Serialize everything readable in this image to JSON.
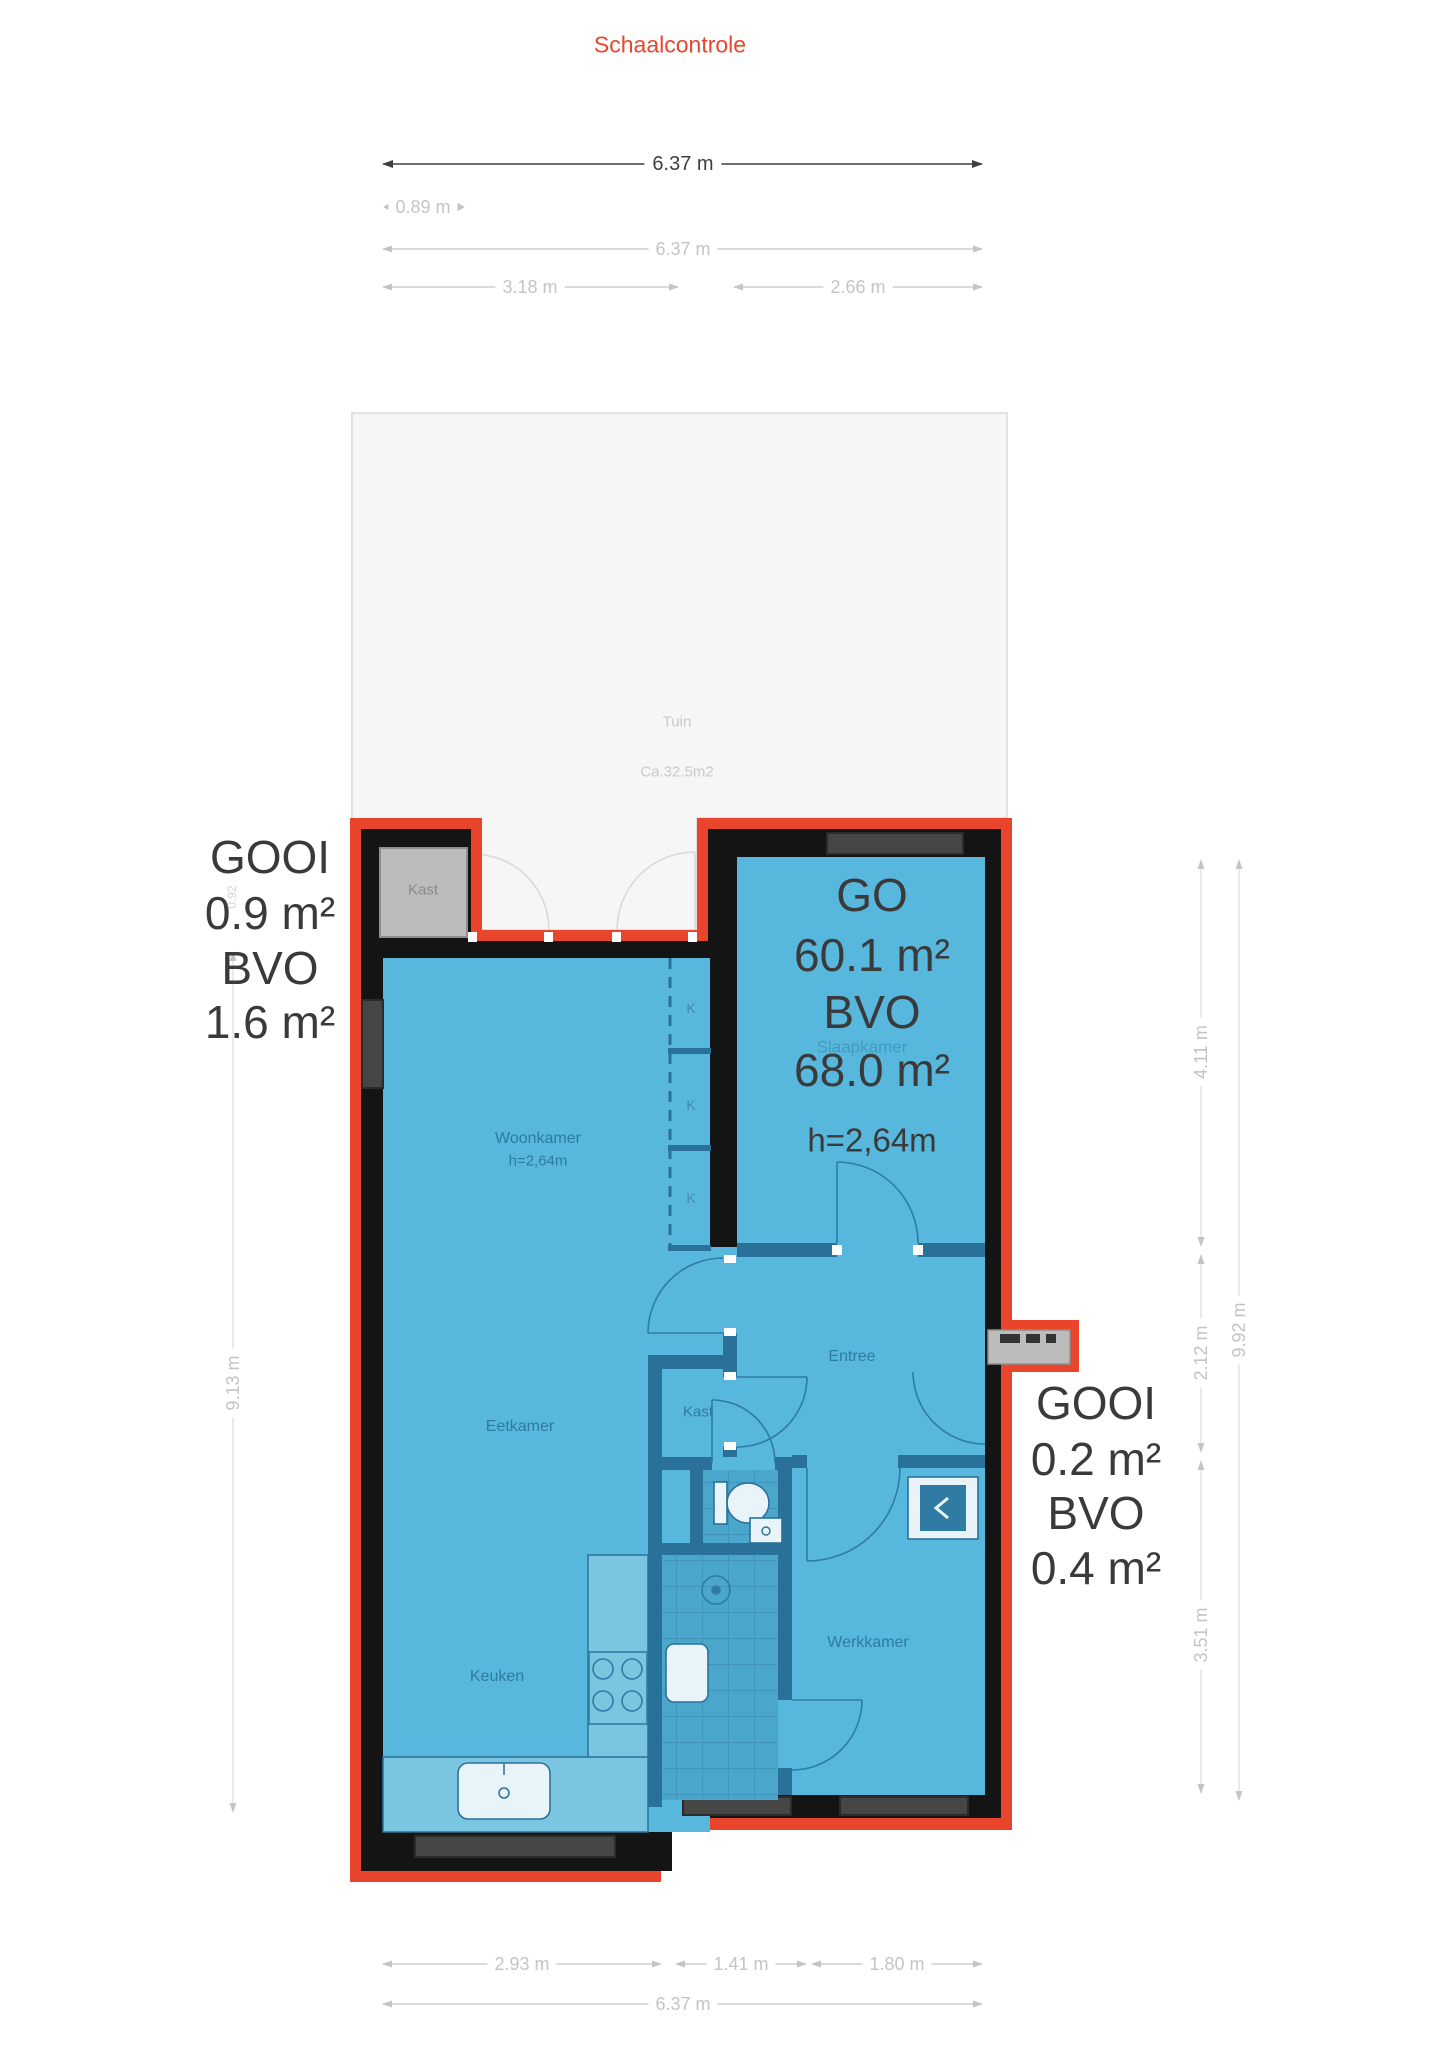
{
  "title": "Schaalcontrole",
  "garden": {
    "name": "Tuin",
    "area": "Ca.32.5m2"
  },
  "dims": {
    "top_main": "6.37 m",
    "top_offset": "0.89 m",
    "top_full": "6.37 m",
    "top_left": "3.18 m",
    "top_right": "2.66 m",
    "left_height": "9.13 m",
    "bump_height": "0.92",
    "right_seg1": "4.11 m",
    "right_seg2": "2.12 m",
    "right_seg3": "3.51 m",
    "right_full": "9.92 m",
    "bottom_left": "2.93 m",
    "bottom_mid": "1.41 m",
    "bottom_right": "1.80 m",
    "bottom_full": "6.37 m"
  },
  "area_left": {
    "line1": "GOOI",
    "line2": "0.9 m²",
    "line3": "BVO",
    "line4": "1.6 m²"
  },
  "area_right": {
    "line1": "GOOI",
    "line2": "0.2 m²",
    "line3": "BVO",
    "line4": "0.4 m²"
  },
  "area_main": {
    "line1": "GO",
    "line2": "60.1 m²",
    "line3": "BVO",
    "line4": "68.0 m²",
    "line5": "h=2,64m"
  },
  "rooms": {
    "woonkamer": "Woonkamer",
    "woonkamer_height": "h=2,64m",
    "slaapkamer": "Slaapkamer",
    "eetkamer": "Eetkamer",
    "keuken": "Keuken",
    "entree": "Entree",
    "werkkamer": "Werkkamer",
    "kast_bump": "Kast",
    "kast_center": "Kast",
    "closet1": "K",
    "closet2": "K",
    "closet3": "K"
  },
  "colors": {
    "accent_red": "#e8452c",
    "wall_black": "#141414",
    "floor_blue": "#58b7dc",
    "interior_wall": "#2a7199",
    "closet_gray": "#bcbcbc",
    "garden_gray": "#f6f6f6",
    "dim_gray": "#c4c4c4",
    "label_dark": "#3a3a3a"
  }
}
